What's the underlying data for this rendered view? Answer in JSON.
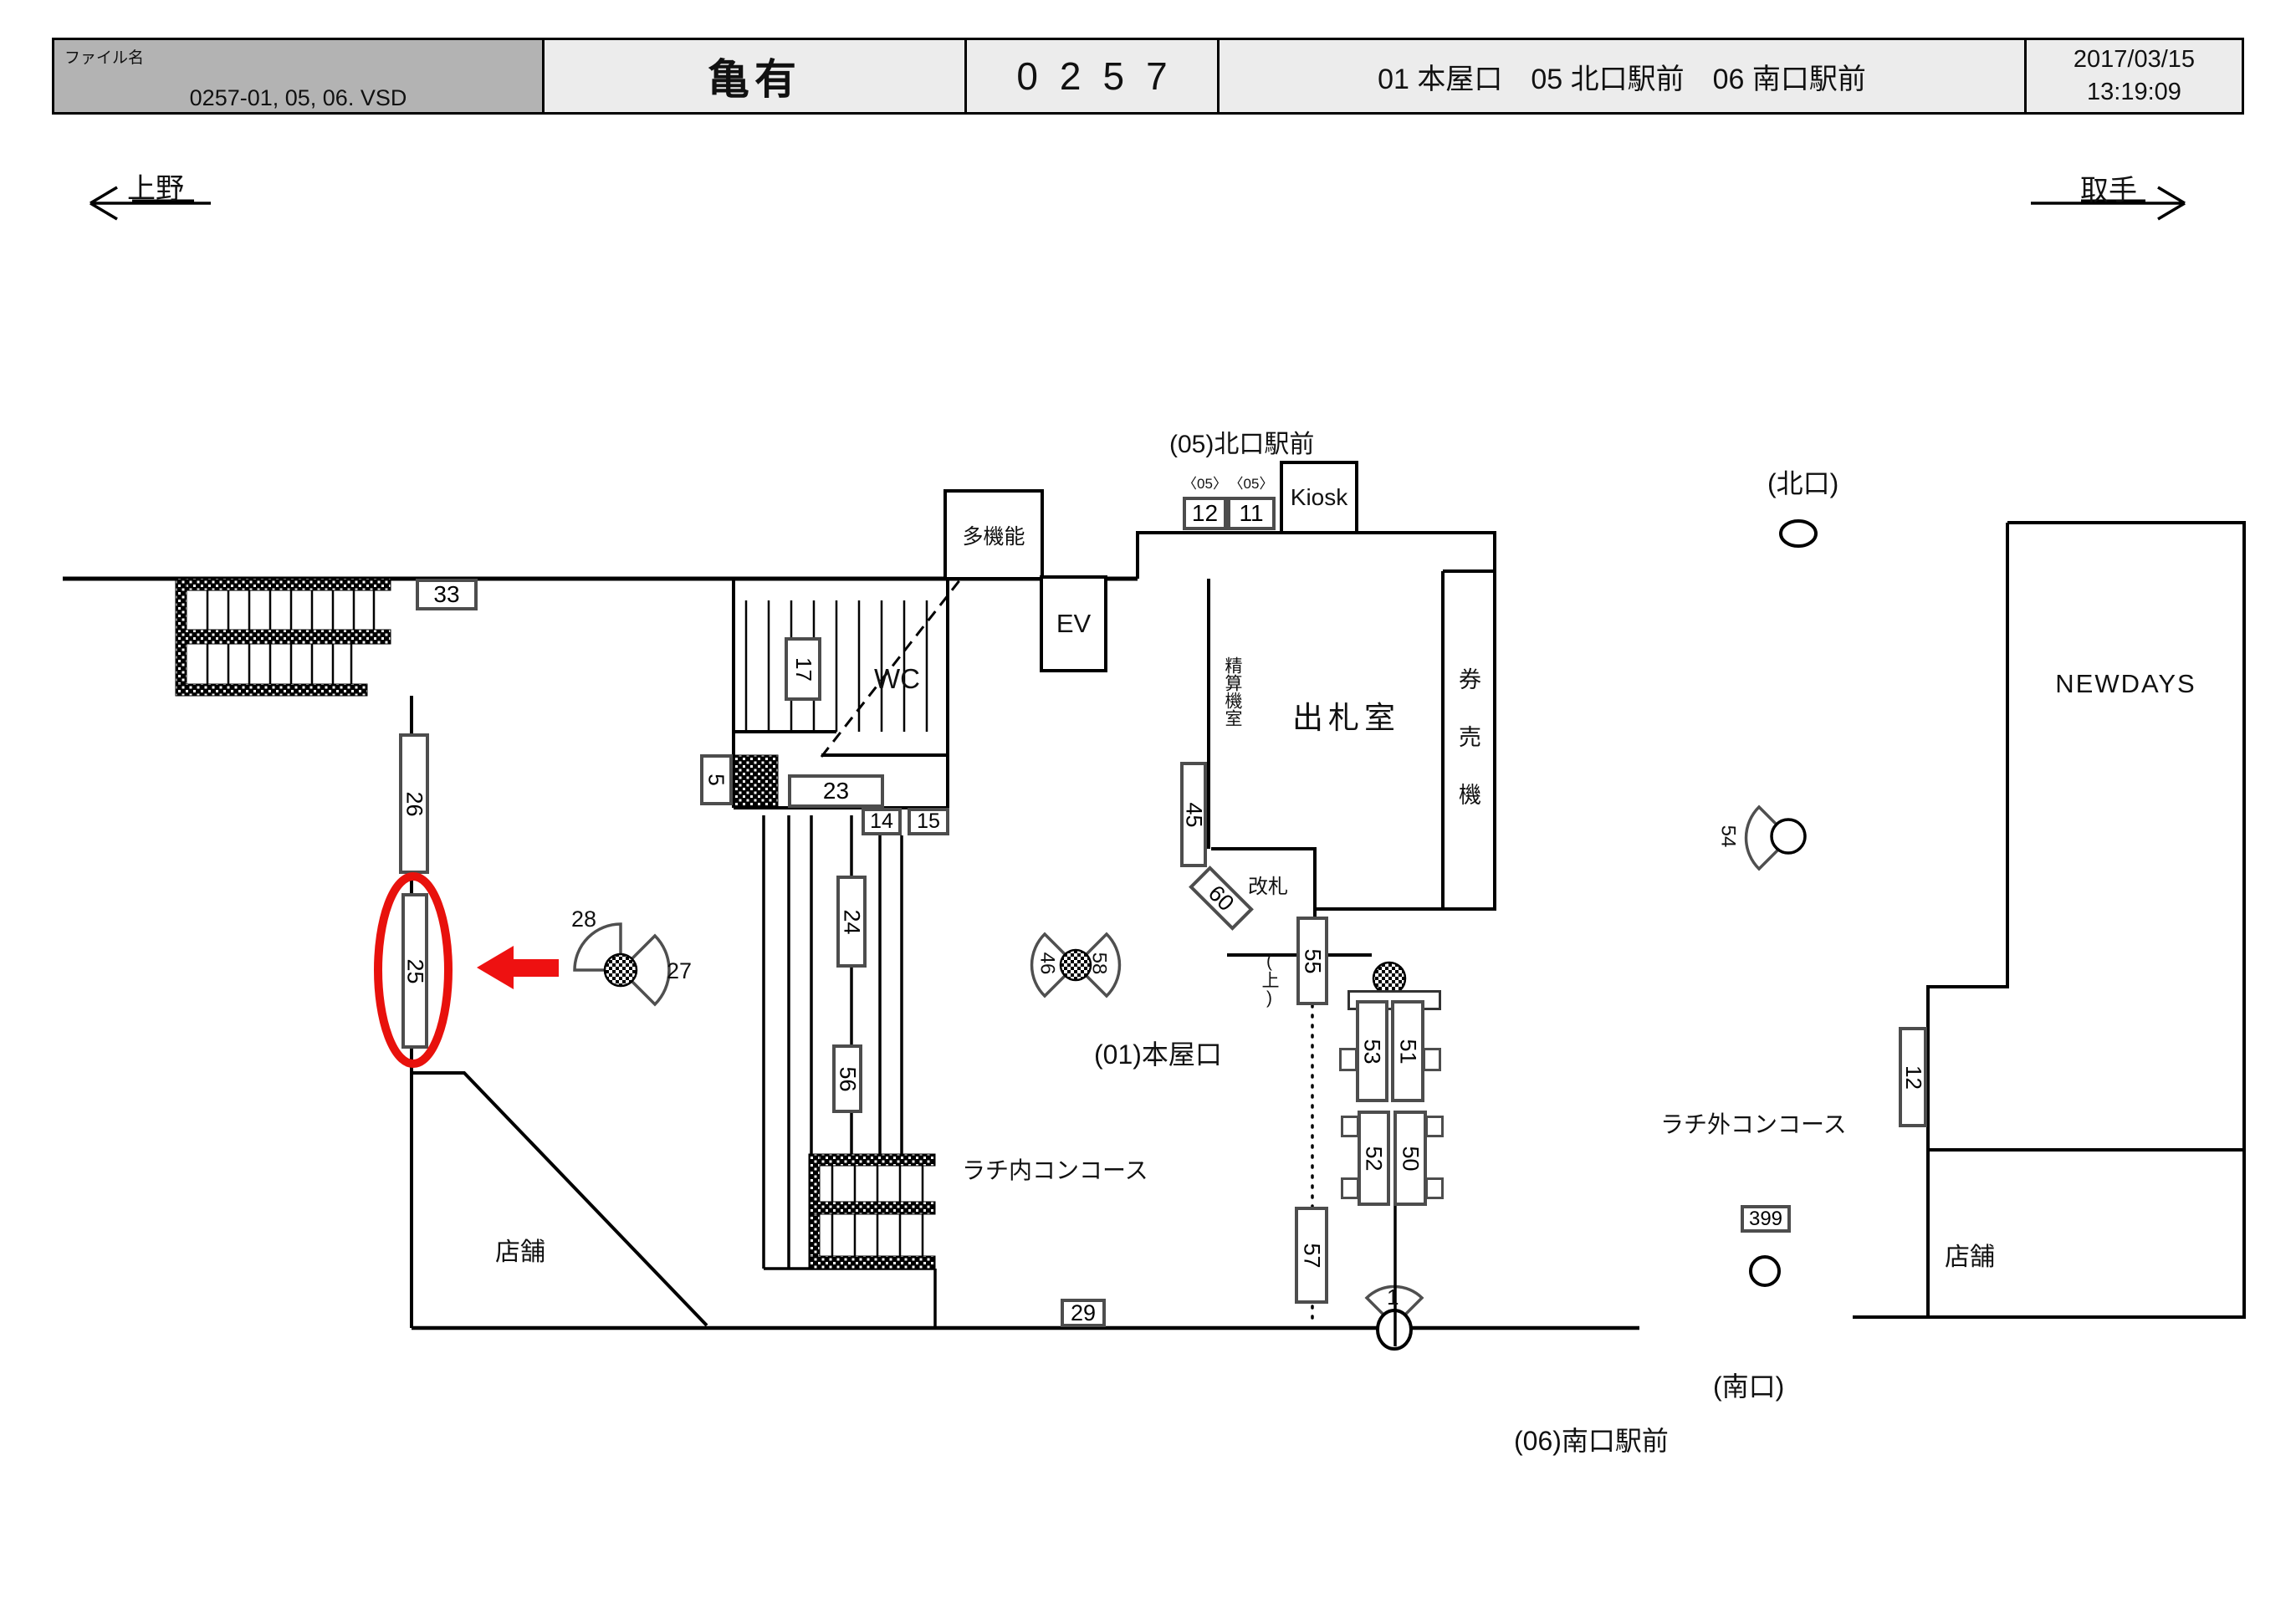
{
  "header": {
    "file_label": "ファイル名",
    "file_name": "0257-01, 05, 06. VSD",
    "station_name": "亀有",
    "station_code": "0257",
    "locations": "01 本屋口　05 北口駅前　06 南口駅前",
    "date": "2017/03/15",
    "time": "13:19:09"
  },
  "nav": {
    "left_station": "上野",
    "right_station": "取手"
  },
  "labels": {
    "north_gate_front": "(05)北口駅前",
    "kiosk": "Kiosk",
    "badge_05_a": "〈05〉",
    "badge_05_b": "〈05〉",
    "multifunction": "多機能",
    "elevator": "EV",
    "wc": "WC",
    "ticket_office": "出札室",
    "fare_adjust_room": "精算機室",
    "ticket_machines": "券売機",
    "gate": "改札",
    "up": "(上)",
    "main_entrance": "(01)本屋口",
    "inside_concourse": "ラチ内コンコース",
    "outside_concourse": "ラチ外コンコース",
    "north_exit": "(北口)",
    "south_exit": "(南口)",
    "south_gate_front": "(06)南口駅前",
    "newdays": "NEWDAYS",
    "shop_left": "店舗",
    "shop_right": "店舗"
  },
  "signs": {
    "s33": "33",
    "s26": "26",
    "s25": "25",
    "s17": "17",
    "s5": "5",
    "s23": "23",
    "s14": "14",
    "s15": "15",
    "s24": "24",
    "s56": "56",
    "s12_top": "12",
    "s11": "11",
    "s45": "45",
    "s60": "60",
    "s55": "55",
    "s57": "57",
    "s53": "53",
    "s51": "51",
    "s52": "52",
    "s50": "50",
    "s29": "29",
    "s399": "399",
    "s12_right": "12",
    "f28": "28",
    "f27": "27",
    "f46": "46",
    "f58": "58",
    "f54": "54",
    "f1": "1"
  },
  "colors": {
    "highlight_red": "#e8110c",
    "line_black": "#000000",
    "sign_border_gray": "#4d4d4d",
    "header_gray": "#b3b3b3",
    "header_light": "#ececec"
  }
}
